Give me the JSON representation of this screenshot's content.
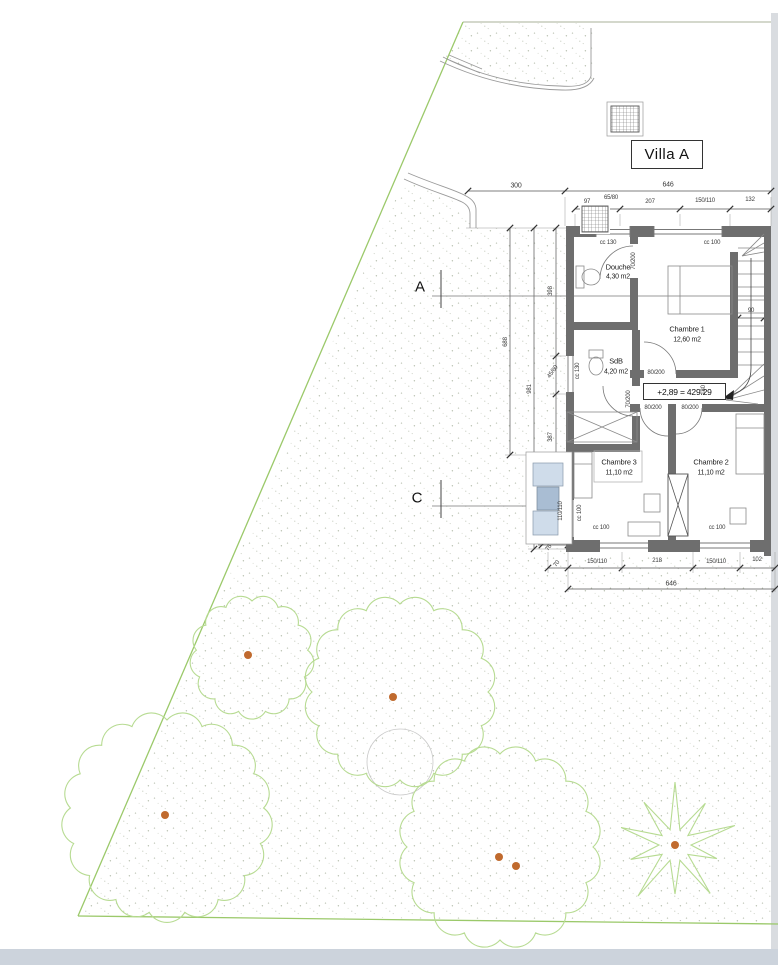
{
  "title": "Villa A",
  "sections": {
    "a": "A",
    "c": "C"
  },
  "level_mark": "+2,89 = 429.29",
  "rooms": [
    {
      "name": "Douche",
      "area": "4,30 m2"
    },
    {
      "name": "Chambre 1",
      "area": "12,60 m2"
    },
    {
      "name": "SdB",
      "area": "4,20 m2"
    },
    {
      "name": "Chambre 3",
      "area": "11,10 m2"
    },
    {
      "name": "Chambre 2",
      "area": "11,10 m2"
    }
  ],
  "dimensions": {
    "top_row": [
      "300",
      "646"
    ],
    "top_detail": [
      "97",
      "65/80",
      "207",
      "150/110",
      "132"
    ],
    "bottom_detail": [
      "70",
      "150/110",
      "218",
      "150/110",
      "102"
    ],
    "bottom_row": [
      "646"
    ],
    "left": [
      "398",
      "688",
      "981",
      "387",
      "45/60"
    ],
    "stair_width": "90",
    "landing": "180",
    "bay_width": "76"
  },
  "openings": {
    "windows": [
      {
        "sill": "cc 130"
      },
      {
        "sill": "cc 100"
      },
      {
        "sill": "cc 130"
      },
      {
        "sill": "cc 100"
      },
      {
        "sill": "cc 100"
      },
      {
        "sill": "cc 100"
      }
    ],
    "bay_size": "110/110",
    "doors": [
      "70/200",
      "70/200",
      "80/200",
      "80/200",
      "80/200"
    ]
  },
  "site": {
    "trees": [
      {
        "cx": 252,
        "cy": 657,
        "r": 56,
        "bumps": 13,
        "dots": [
          [
            248,
            655
          ]
        ]
      },
      {
        "cx": 400,
        "cy": 692,
        "r": 88,
        "bumps": 16,
        "dots": [
          [
            393,
            697
          ]
        ]
      },
      {
        "cx": 167,
        "cy": 817,
        "r": 97,
        "bumps": 17,
        "dots": [
          [
            165,
            815
          ]
        ]
      },
      {
        "cx": 500,
        "cy": 847,
        "r": 93,
        "bumps": 16,
        "dots": [
          [
            499,
            857
          ],
          [
            516,
            866
          ]
        ]
      }
    ],
    "palm": {
      "cx": 675,
      "cy": 845,
      "outer": 63,
      "inner": 16,
      "points": 10,
      "dot": [
        675,
        845
      ]
    }
  },
  "colors": {
    "boundary_green": "#9bc96a",
    "tree_green": "#b7db92",
    "dot_orange": "#c06a2e",
    "wall_gray": "#6e6e6e",
    "bay_blue_light": "#cfdcea",
    "bay_blue_mid": "#a9bdd3"
  }
}
